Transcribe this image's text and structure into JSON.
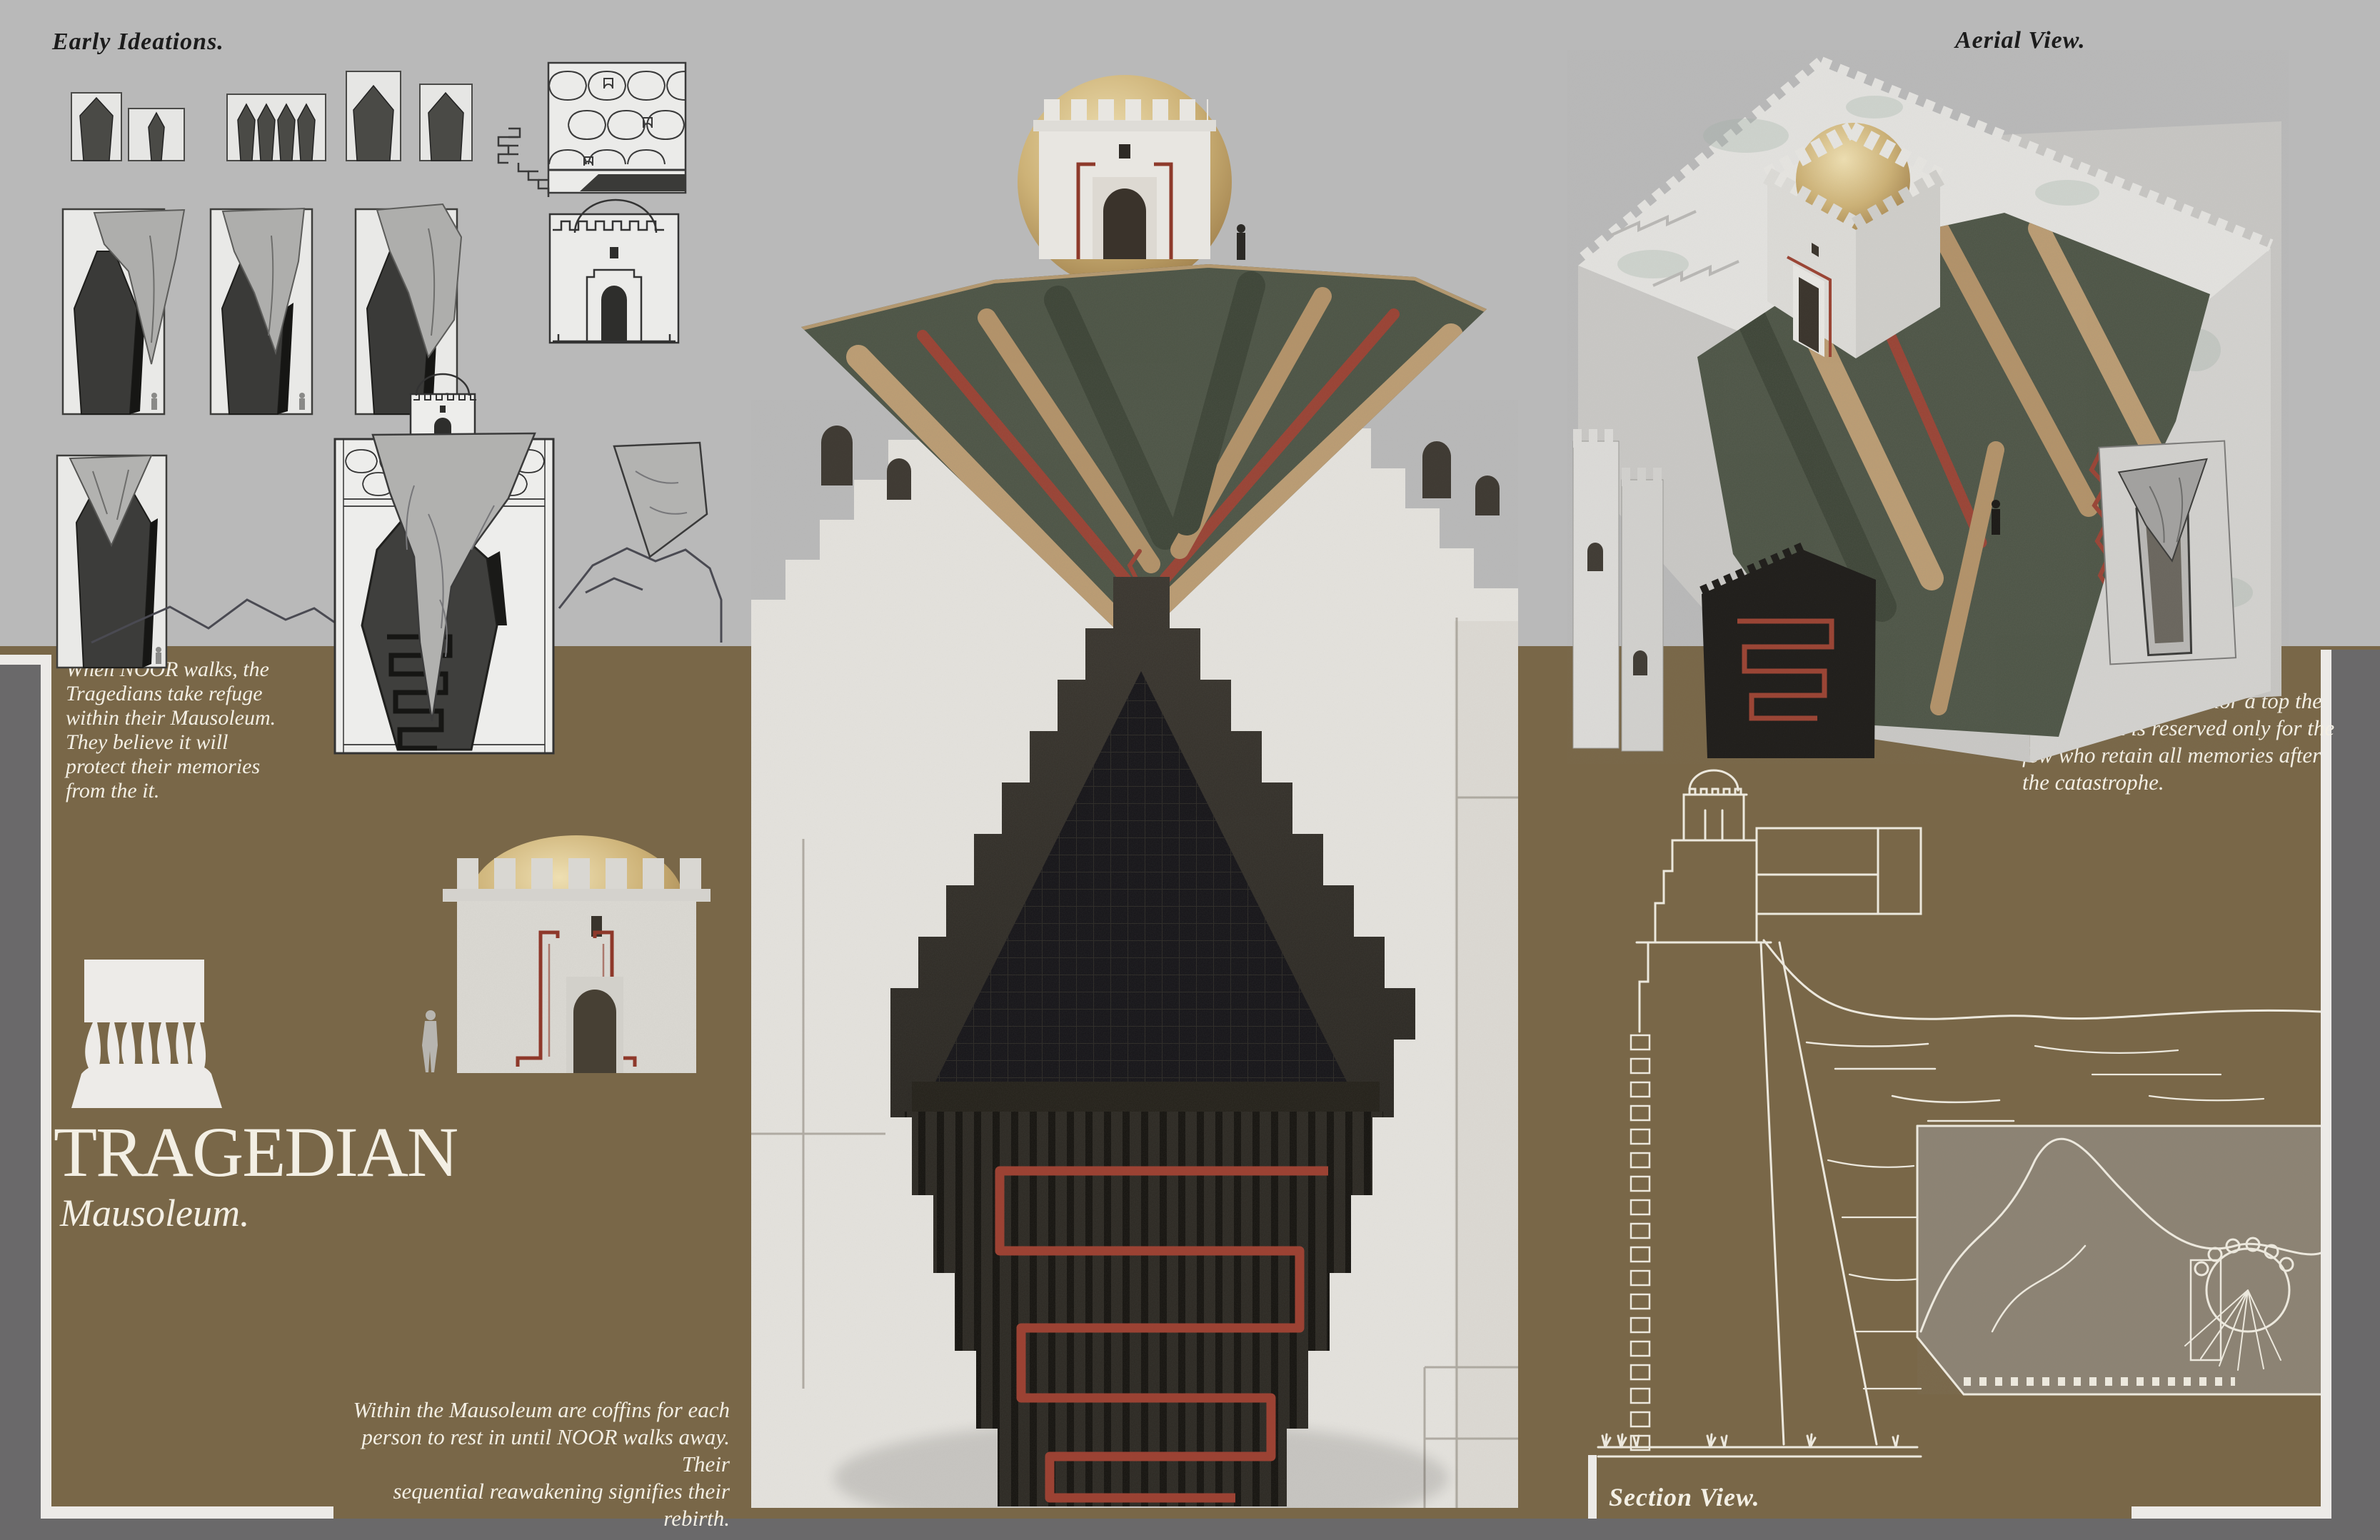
{
  "board": {
    "title": "TRAGEDIAN",
    "subtitle": "Mausoleum.",
    "labels": {
      "early_ideations": "Early Ideations.",
      "aerial_view": "Aerial View.",
      "section_view": "Section View."
    },
    "paragraphs": {
      "refuge": "When NOOR walks, the\nTragedians take refuge\nwithin their Mausoleum.\nThey believe it will\nprotect their memories\nfrom the it.",
      "manor": "The Adventurer’s Manor a top the\nMausoleum is reserved only for the\nfew who retain all memories after\nthe catastrophe.",
      "coffins": "Within the Mausoleum are coffins for each\nperson to rest in until NOOR walks away. Their\nsequential reawakening signifies their rebirth."
    },
    "illustrations": {
      "early_ideation_sketches": "coffin-form-studies",
      "elevation_sketch": "mausoleum-elevation-line-sketch",
      "tragedian_logo": "figures-carrying-slab-emblem",
      "small_render": "mausoleum-front-render-with-scale-figure",
      "center_render": "mausoleum-wall-with-draped-carpet-render",
      "aerial_render": "mausoleum-aerial-render-with-gold-dome",
      "section_drawing": "mausoleum-section-line-drawing"
    },
    "colors": {
      "bg_gray": "#b9b9b9",
      "band_brown": "#796748",
      "margin_gray": "#6a696a",
      "frame_white": "#eceae7",
      "text_dark": "#1c1c1c",
      "text_light": "#f3efe4",
      "accent_red": "#9c4132",
      "gold_dome": "#cdb277",
      "carpet_green": "#4c5445",
      "carpet_tan": "#bf9f74",
      "stone_white": "#e2e0db",
      "coffin_dark": "#211f1b",
      "chamber_fill": "#8d8373"
    }
  }
}
